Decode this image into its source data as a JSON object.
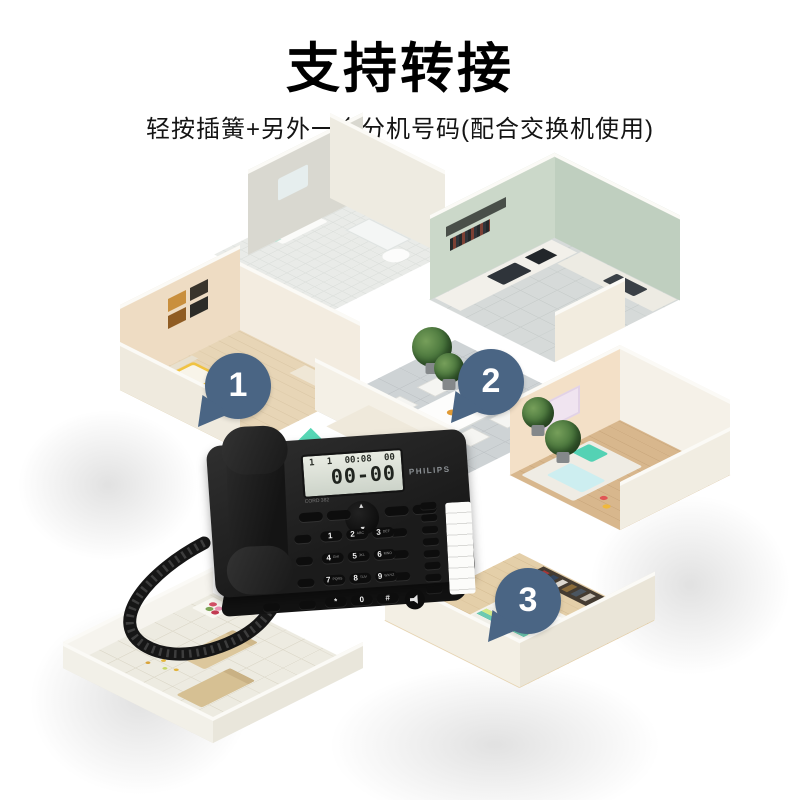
{
  "header": {
    "title": "支持转接",
    "subtitle": "轻按插簧+另外一个分机号码(配合交换机使用)"
  },
  "pins": [
    {
      "label": "1"
    },
    {
      "label": "2"
    },
    {
      "label": "3"
    }
  ],
  "pin_color": "#4a6584",
  "phone": {
    "brand": "PHILIPS",
    "model": "CORD 382",
    "display": {
      "count_a": "1",
      "count_b": "1",
      "time": "00:08",
      "calls": "00",
      "main": "00-00"
    },
    "nav_up": "▲",
    "nav_down": "▼",
    "keys": [
      {
        "d": "1",
        "s": ""
      },
      {
        "d": "2",
        "s": "ABC"
      },
      {
        "d": "3",
        "s": "DEF"
      },
      {
        "d": "4",
        "s": "GHI"
      },
      {
        "d": "5",
        "s": "JKL"
      },
      {
        "d": "6",
        "s": "MNO"
      },
      {
        "d": "7",
        "s": "PQRS"
      },
      {
        "d": "8",
        "s": "TUV"
      },
      {
        "d": "9",
        "s": "WXYZ"
      },
      {
        "d": "*",
        "s": ""
      },
      {
        "d": "0",
        "s": ""
      },
      {
        "d": "#",
        "s": ""
      }
    ]
  },
  "colors": {
    "pin": "#4a6584",
    "phone_body": "#1b1b1b",
    "lcd": "#dce1d6",
    "kitchen_wall": "#c9d7c8",
    "bedroom_wall": "#eedcc3",
    "outer_wall": "#f5f2ea",
    "wood_floor": "#d8b78d",
    "tile_floor": "#ced3d5",
    "bed_blanket": "#f0c342",
    "teal_pillow": "#54d2b4"
  }
}
